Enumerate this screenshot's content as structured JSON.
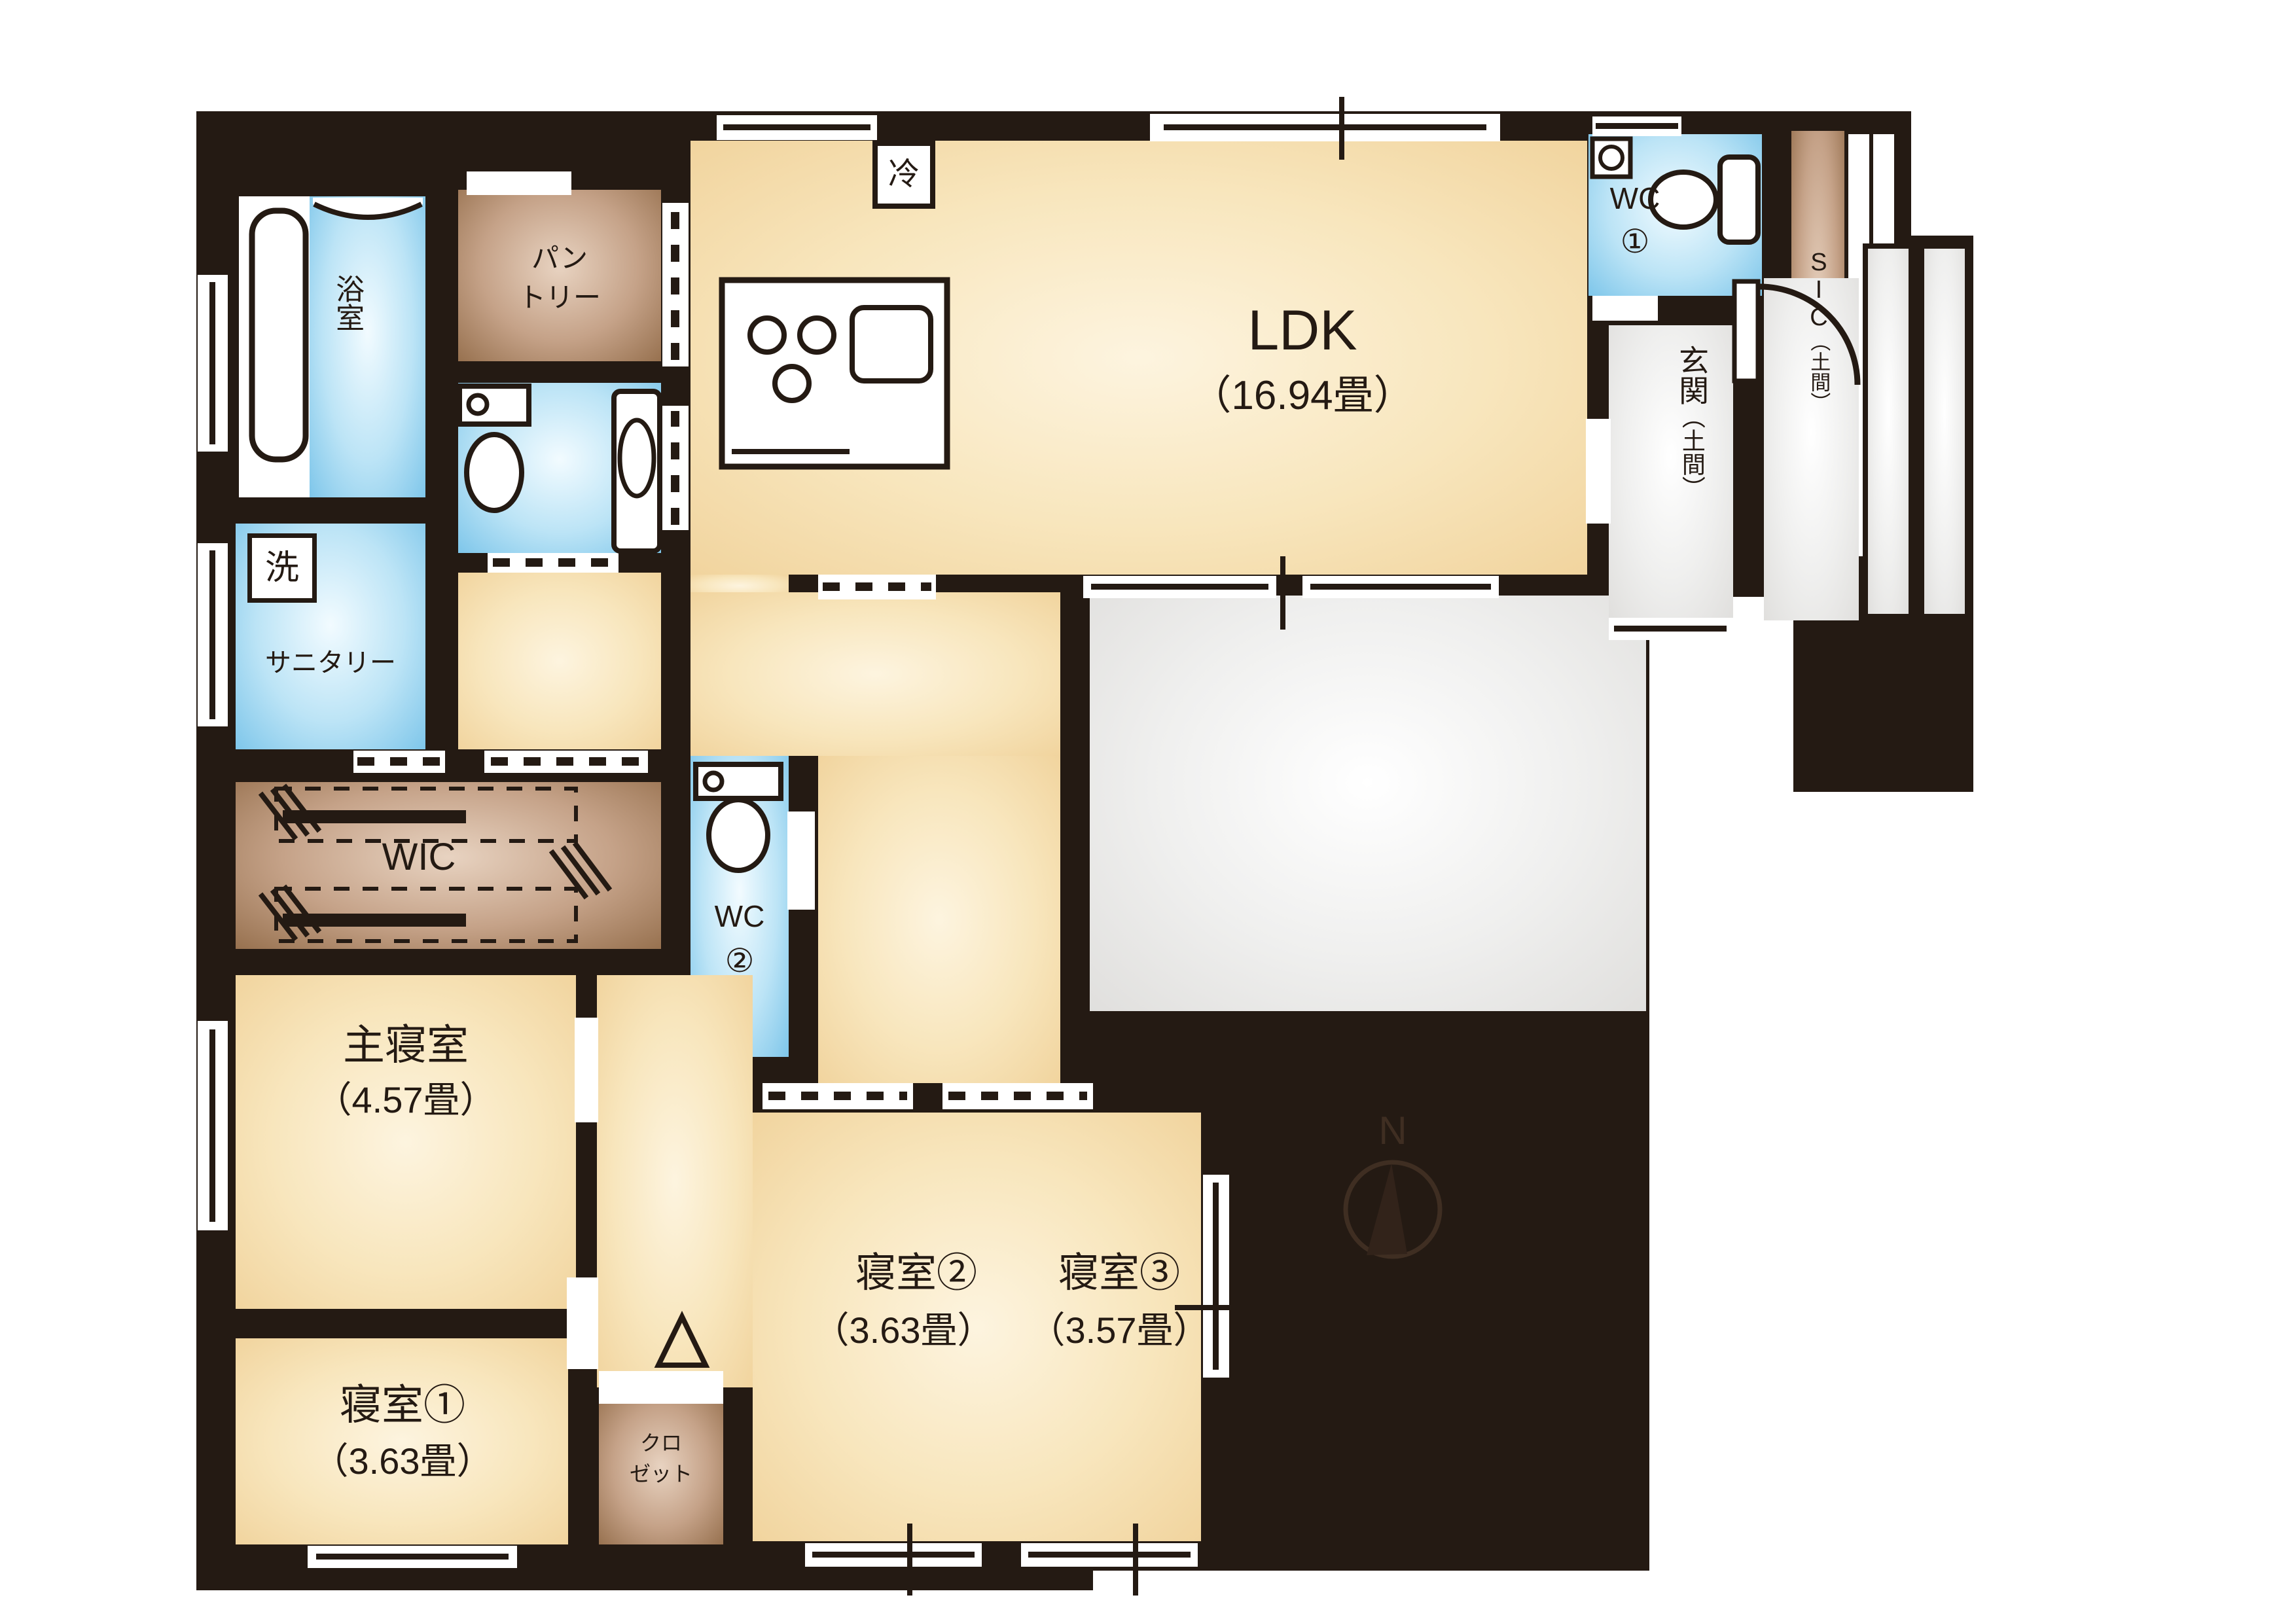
{
  "rooms": {
    "ldk": {
      "name": "LDK",
      "area": "（16.94畳）"
    },
    "bath": {
      "name": "浴室"
    },
    "pantry": {
      "line1": "パン",
      "line2": "トリー"
    },
    "laundry": {
      "name": "洗"
    },
    "sanitary": {
      "name": "サニタリー"
    },
    "wic": {
      "name": "WIC"
    },
    "wc1": {
      "line1": "WC",
      "line2": "①"
    },
    "wc2": {
      "line1": "WC",
      "line2": "②"
    },
    "master_bedroom": {
      "name": "主寝室",
      "area": "（4.57畳）"
    },
    "bedroom1": {
      "name": "寝室①",
      "area": "（3.63畳）"
    },
    "bedroom2": {
      "name": "寝室②",
      "area": "（3.63畳）"
    },
    "bedroom3": {
      "name": "寝室③",
      "area": "（3.57畳）"
    },
    "closet": {
      "line1": "クロ",
      "line2": "ゼット"
    },
    "sic": {
      "name": "SIC",
      "qualifier": "（土間）"
    },
    "entrance": {
      "name": "玄関",
      "qualifier": "（土間）"
    },
    "refrigerator": {
      "name": "冷"
    }
  },
  "compass": {
    "label": "N"
  },
  "colors": {
    "wall": "#241a13",
    "floor_beige": "#f1d49e",
    "water_blue": "#7ec6ea",
    "storage_brown": "#97714f",
    "earth_gray": "#e0dfdd"
  }
}
